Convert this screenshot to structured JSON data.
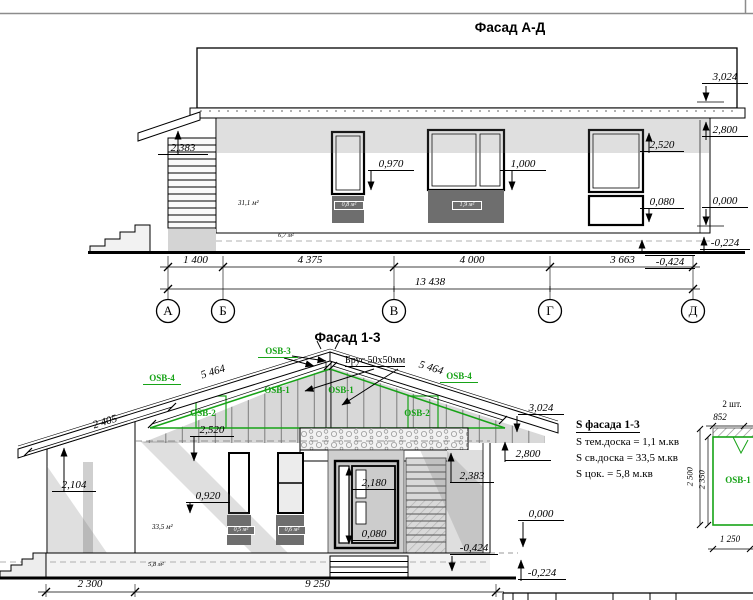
{
  "facade_ad": {
    "title": "Фасад А-Д",
    "axes": [
      "А",
      "Б",
      "В",
      "Г",
      "Д"
    ],
    "dims": {
      "d1": "1 400",
      "d2": "4 375",
      "d3": "4 000",
      "d4": "3 663",
      "total": "13 438"
    },
    "marks": {
      "h2383": "2,383",
      "h0970": "0,970",
      "h1000": "1,000",
      "h2520": "2,520",
      "h0080": "0,080",
      "h3024": "3,024",
      "h2800": "2,800",
      "h0000": "0,000",
      "hm0224": "-0,224",
      "hm0424": "-0,424"
    },
    "areas": {
      "wall": "31,1 м²",
      "window1": "0,8 м²",
      "window2": "1,9 м²",
      "plinth": "6,7 м²"
    }
  },
  "facade_13": {
    "title": "Фасад 1-3",
    "osb": {
      "osb1": "OSB-1",
      "osb2": "OSB-2",
      "osb3": "OSB-3",
      "osb4": "OSB-4"
    },
    "notes": {
      "brus": "Брус 50х50мм"
    },
    "dims": {
      "slope_left": "5 464",
      "slope_right": "5 464",
      "canopy": "2 405",
      "left": "2 300",
      "right": "9 250"
    },
    "marks": {
      "h2520": "2,520",
      "h2104": "2,104",
      "h0920": "0,920",
      "h2180": "2,180",
      "h0080": "0,080",
      "h2383": "2,383",
      "h3024": "3,024",
      "h2800": "2,800",
      "h0000": "0,000",
      "hm0424": "-0,424",
      "hm0224": "-0,224"
    },
    "areas": {
      "wall": "33,5 м²",
      "window1": "0,5 м²",
      "window2": "0,6 м²",
      "plinth": "5,8 м²"
    }
  },
  "legend": {
    "title": "S фасада 1-3",
    "rows": [
      "S тем.доска = 1,1 м.кв",
      "S св.доска = 33,5 м.кв",
      "S цок. = 5,8 м.кв"
    ]
  },
  "panel": {
    "count": "2 шт.",
    "width_top": "852",
    "height_outer": "2 500",
    "height_inner": "2 350",
    "name": "OSB-1",
    "width_bottom": "1 250"
  },
  "colors": {
    "green": "#17a317",
    "panel_dark": "#6e6e6e"
  }
}
